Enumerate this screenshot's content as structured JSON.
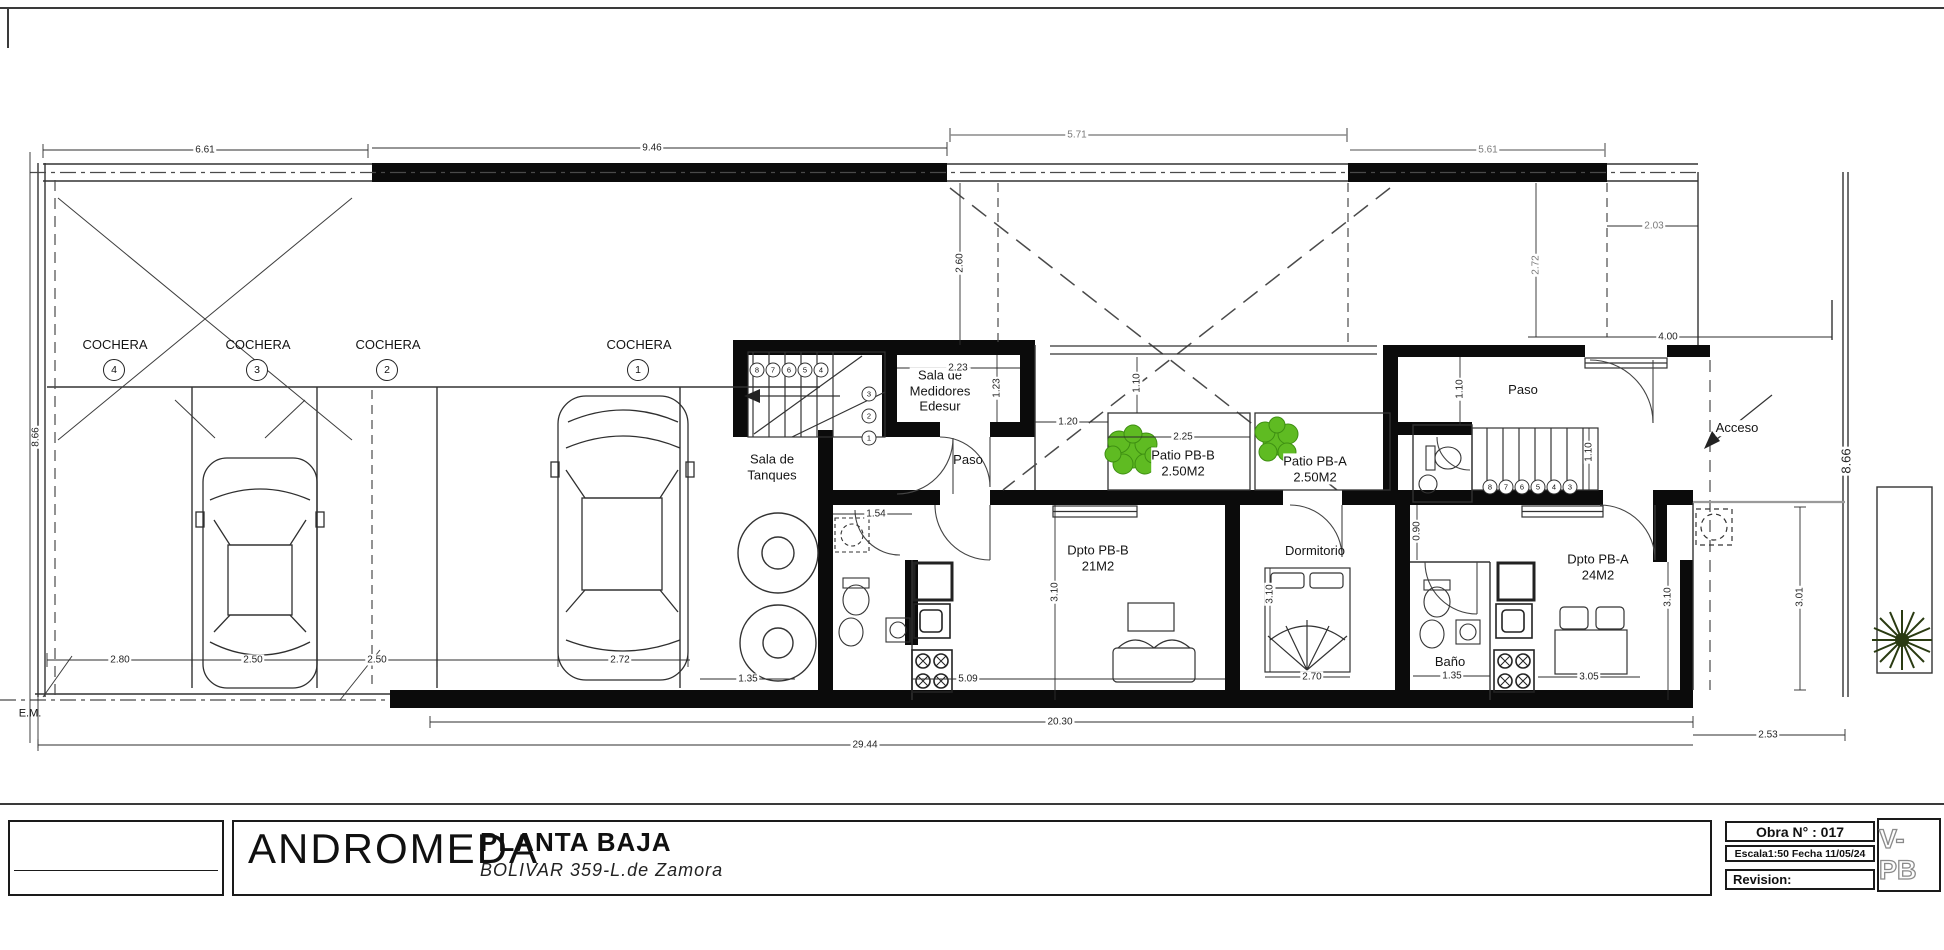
{
  "title_block": {
    "project": "ANDROMEDA",
    "drawing": "PLANTA BAJA",
    "address": "BOLIVAR 359-L.de Zamora",
    "obra": "Obra N° : 017",
    "escala_fecha": "Escala1:50 Fecha 11/05/24",
    "revision": "Revision:",
    "sheet_code": "V-PB"
  },
  "rooms": {
    "cochera": {
      "label": "COCHERA",
      "numbers": [
        "4",
        "3",
        "2",
        "1"
      ]
    },
    "sala_tanques": "Sala de\nTanques",
    "sala_medidores": "Sala de\nMedidores\nEdesur",
    "paso_left": "Paso",
    "paso_right": "Paso",
    "patio_b": "Patio PB-B\n2.50M2",
    "patio_a": "Patio PB-A\n2.50M2",
    "dpto_b": "Dpto PB-B\n21M2",
    "dormitorio": "Dormitorio",
    "bano": "Baño",
    "dpto_a": "Dpto PB-A\n24M2",
    "acceso": "Acceso",
    "em": "E.M."
  },
  "dims": {
    "top_661": "6.61",
    "top_946": "9.46",
    "top_571": "5.71",
    "top_561": "5.61",
    "right_203": "2.03",
    "right_272v": "2.72",
    "right_400": "4.00",
    "mid_260v": "2.60",
    "left_866v": "8.66",
    "right_866v": "8.66",
    "right_301v": "3.01",
    "bottom_253": "2.53",
    "coch4_280": "2.80",
    "coch3_250": "2.50",
    "coch2_250": "2.50",
    "coch1_272": "2.72",
    "tanq_154": "1.54",
    "banob_135": "1.35",
    "living_509": "5.09",
    "bed_270": "2.70",
    "banoa_135": "1.35",
    "table_305": "3.05",
    "total_2030": "20.30",
    "total_2944": "29.44",
    "med_223": "2.23",
    "med_123v": "1.23",
    "patio_120": "1.20",
    "patio_225": "2.25",
    "patio_110v": "1.10",
    "paso_110v": "1.10",
    "stair_110v": "1.10",
    "dptob_310v": "3.10",
    "dorm_310v": "3.10",
    "dptoa_310v": "3.10",
    "bath_090v": "0.90"
  },
  "stairs": {
    "left_steps": [
      "8",
      "7",
      "6",
      "5",
      "4"
    ],
    "left_lower": [
      "3",
      "2",
      "1"
    ],
    "right_steps": [
      "8",
      "7",
      "6",
      "5",
      "4",
      "3"
    ]
  },
  "colors": {
    "wall": "#0b0b0b",
    "line": "#333333",
    "gray_dim": "#8a8a8a",
    "plant_green": "#5fbb22",
    "plant_dark": "#2a3b12"
  }
}
